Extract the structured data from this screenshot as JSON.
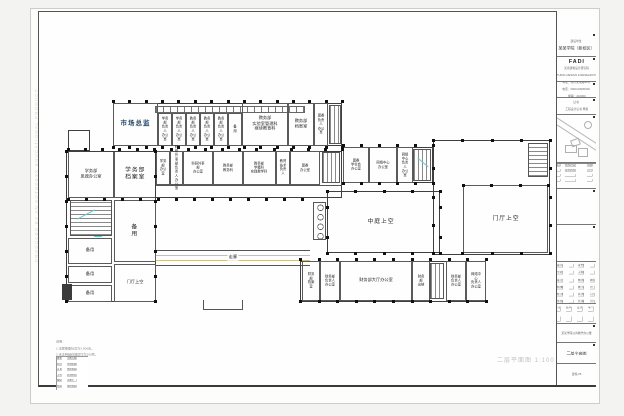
{
  "titleblock": {
    "client_label": "建设单位",
    "client_value": "某某学院（新校区）",
    "firm_logo": "FADI",
    "firm_name": "某省建筑设计研究院",
    "firm_en": "ARCHITECTURAL DESIGN & RESEARCH INSTITUTE",
    "contact_lines": [
      "地址：某市某某路99号",
      "电话：0000-00000000",
      "邮编：210000"
    ],
    "cert_label": "证书",
    "cert_value": "工程设计证书 甲级",
    "rev_headers": [
      "版次",
      "修改内容",
      "日期"
    ],
    "rev_rows": [
      [
        "1",
        "会审修改",
        "03.6"
      ],
      [
        "",
        "",
        ""
      ],
      [
        "",
        "",
        ""
      ]
    ],
    "sign_left": [
      [
        "设计总负责",
        ""
      ],
      [
        "专业负责人",
        ""
      ],
      [
        "设 计",
        ""
      ],
      [
        "制 图",
        ""
      ],
      [
        "校 对",
        ""
      ],
      [
        "审 核",
        ""
      ]
    ],
    "sign_right": [
      [
        "证书编号",
        ""
      ],
      [
        "工程编号",
        ""
      ],
      [
        "图 别",
        "建施"
      ],
      [
        "图 号",
        "05"
      ],
      [
        "比 例",
        "1:100"
      ],
      [
        "日 期",
        "03.06"
      ]
    ],
    "hq_rows": [
      [
        "建 筑",
        "结 构",
        "设 备",
        "电 气"
      ],
      [
        "",
        "",
        "",
        ""
      ]
    ],
    "project_value": "某某学院公共教学办公楼",
    "title_value": "二层平面图",
    "number_value": "建施-05"
  },
  "plan": {
    "caption": "二层平面图 1:100",
    "corridor_label": "走廊",
    "watermark": "PRODUCED BY AN AUTODESK EDUCATIONAL PRODUCT",
    "notes": [
      "说明：",
      "1.本层楼面标高为3.900米。",
      "2.未注明轴线墙体均为200厚。"
    ],
    "table_rows": [
      [
        "教室",
        "水磨石楼面"
      ],
      [
        "办公室",
        "木地板楼面"
      ],
      [
        "走 廊",
        "地砖楼面"
      ],
      [
        "卫生间",
        "防滑地砖"
      ],
      [
        "楼梯间",
        "水磨石"
      ],
      [
        "档案室",
        "地砖楼面"
      ]
    ],
    "rooms": {
      "shichang": "市场总监",
      "xw_fzr1": "学务部\n负责人\n办公室",
      "xw_fzr2": "学务部\n负责人\n办公室",
      "jw_fzr1": "教务部\n负责人\n办公室",
      "jw_fzr2": "教务部\n负责人\n办公室",
      "jw_fzr3": "教务部\n负责人\n办公室",
      "beiyong_top": "备\n用",
      "shiyan": "教务部\n实验室管理科\n继续教育科",
      "jw_dangan": "教务部\n档案室",
      "tw_fzr": "团委\n负责人\n办公室",
      "sizheng": "学务部\n思政办公室",
      "xw_dangan": "学务部\n档案室",
      "xw_bgs": "学务部\n办公室",
      "kyws_fzr": "科研外事部\n负责人\n办公室",
      "kyws": "科研外事部\n办公室",
      "jiaowuke": "教务部\n教务科",
      "xueji": "教务部\n学籍科\n实践教学科",
      "jiaoyujishu": "教育\n技术\n负责人",
      "tw_bgs": "团委\n办公室",
      "tw_xsh": "团委\n学生会\n办公室",
      "wlzx": "网络中心\n办公室",
      "wlzx_fzr": "网络中心\n负责人\n办公室",
      "zhongting": "中庭上空",
      "menting_r": "门厅上空",
      "cw_dangan": "财务部\n档案室",
      "cw_fzr1": "财务部\n负责人\n办公室",
      "cw_dating": "财务部大厅办公室",
      "cw_chuna": "财务部\n出纳",
      "cw_fzr2": "财务部\n负责人\n办公室",
      "wlzx_fzr2": "网络中心\n负责人\n办公室",
      "beiyong_big": "备\n用",
      "beiyong1": "备用",
      "beiyong2": "备用",
      "beiyong3": "备用",
      "menting_l": "门厅上空"
    }
  }
}
